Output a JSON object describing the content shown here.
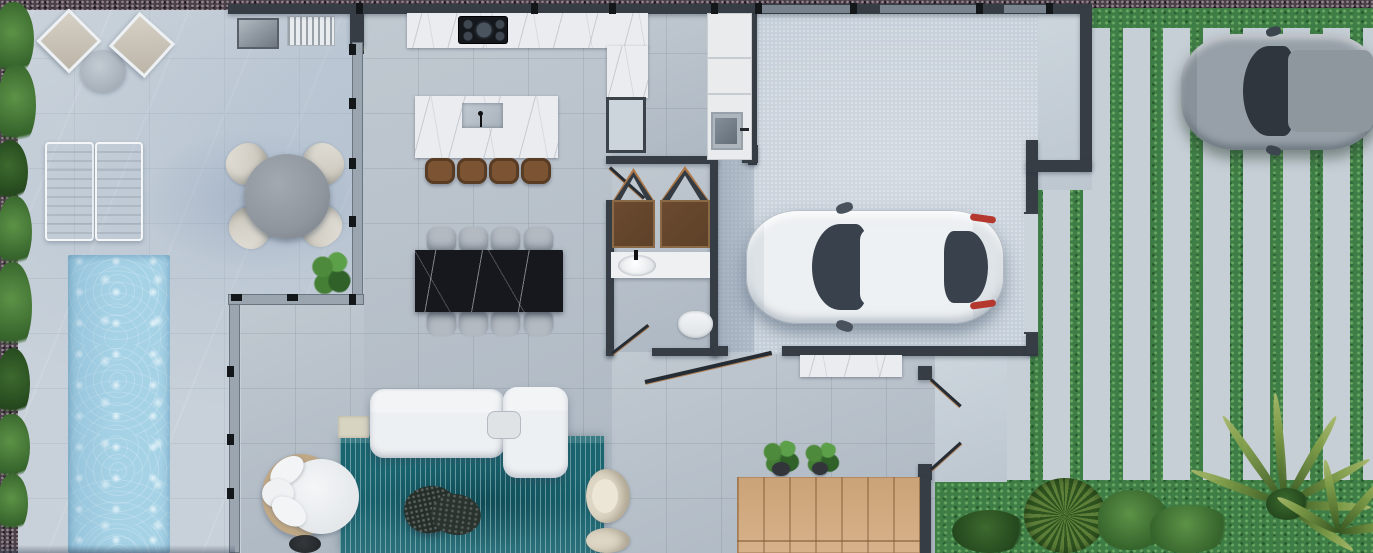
{
  "scene": {
    "description": "Photorealistic top-down 3D architectural floor plan render of a modern single-family villa",
    "view": "top-down orthographic",
    "rooms": [
      {
        "id": "pool-terrace",
        "label": "outdoor terrace with pool, sun loungers and lounge corner"
      },
      {
        "id": "alfresco-dining",
        "label": "covered terrace with round concrete dining table for four"
      },
      {
        "id": "kitchen",
        "label": "kitchen with L-shaped marble counter, cooktop and island with four bar stools"
      },
      {
        "id": "dining-room",
        "label": "dining room with black marble table and eight chairs"
      },
      {
        "id": "living-room",
        "label": "living room with white sectional sofa, teal rug, stone coffee table, papasan chair and two cream armchairs"
      },
      {
        "id": "bathroom",
        "label": "bathroom with double wardrobe closets, vanity sink and wall-hung toilet"
      },
      {
        "id": "laundry-closet",
        "label": "utility closet with cabinets and utility sink"
      },
      {
        "id": "garage",
        "label": "single garage with white sports sedan"
      },
      {
        "id": "driveway",
        "label": "driveway of concrete strip pavers in grass with gray car"
      },
      {
        "id": "garden",
        "label": "side and rear garden with lawn, bushes and palms"
      },
      {
        "id": "wood-patio",
        "label": "timber deck patio at rear of living area"
      }
    ],
    "objects": [
      {
        "id": "pool",
        "label": "swimming pool"
      },
      {
        "id": "sun-lounger",
        "label": "pair of sun loungers"
      },
      {
        "id": "cube-chair",
        "label": "two cube lounge chairs with side table"
      },
      {
        "id": "bbq-grill",
        "label": "grill box"
      },
      {
        "id": "vent-grate",
        "label": "slatted grate unit"
      },
      {
        "id": "outdoor-kitchen-box",
        "label": "dark outdoor kitchen module"
      },
      {
        "id": "round-table",
        "label": "round concrete table with four shell chairs"
      },
      {
        "id": "kitchen-island",
        "label": "marble island with sink and faucet"
      },
      {
        "id": "cooktop",
        "label": "black cooktop with burners"
      },
      {
        "id": "dining-table",
        "label": "black marble dining table"
      },
      {
        "id": "wardrobes",
        "label": "two wood wardrobes with open peaked doors"
      },
      {
        "id": "vanity",
        "label": "vanity counter with oval sink"
      },
      {
        "id": "toilet",
        "label": "wall-hung toilet"
      },
      {
        "id": "utility-sink",
        "label": "utility sink unit"
      },
      {
        "id": "white-car",
        "label": "white car parked in garage facing left"
      },
      {
        "id": "gray-car",
        "label": "gray car on driveway, partially cropped at right edge"
      },
      {
        "id": "sofa",
        "label": "white L-shaped sectional sofa with tray"
      },
      {
        "id": "coffee-table",
        "label": "organic dark terrazzo coffee table"
      },
      {
        "id": "papasan-chair",
        "label": "round rattan chair with white cushions and dark side table"
      },
      {
        "id": "armchairs",
        "label": "two cream barrel armchairs"
      },
      {
        "id": "deck-planters",
        "label": "two potted plants by deck"
      },
      {
        "id": "marble-console",
        "label": "white marble console bench"
      },
      {
        "id": "glass-walls",
        "label": "frameless glass facade walls with dark connectors"
      },
      {
        "id": "hedge",
        "label": "green hedge along left boundary"
      },
      {
        "id": "palms",
        "label": "tropical palms and bushes in bottom-right garden"
      }
    ]
  },
  "palette": {
    "terrace": "#c8d1d9",
    "gravel": "#4a4049",
    "grass": "#3f7d46",
    "paver": "#c6cfd6",
    "pool_water": "#a6d2e6",
    "interior_floor": "#b9c2cb",
    "garage_floor": "#c5cfd9",
    "wall_dark": "#373d45",
    "glass_wall": "#9aa5b0",
    "marble_white": "#eaecef",
    "marble_black": "#16181d",
    "wood_deck": "#d4ac81",
    "rug_teal": "#19646f",
    "sofa_white": "#edf0f2",
    "wood_cabinet": "#5d4128",
    "wood_edge": "#ad7747",
    "stool_brown": "#7c5434",
    "chair_gray": "#b3bac2",
    "cream_chair": "#ded6c4",
    "rattan": "#c0a885",
    "concrete_table": "#8f969e",
    "car_white": "#edf0f2",
    "car_gray": "#97a0a8",
    "car_glass": "#39424c",
    "taillight_red": "#b5382f",
    "plant_green": "#4e8a3c",
    "plant_dark": "#24471d",
    "threshold": "#ccd4db",
    "laundry_white": "#e9ebed"
  }
}
